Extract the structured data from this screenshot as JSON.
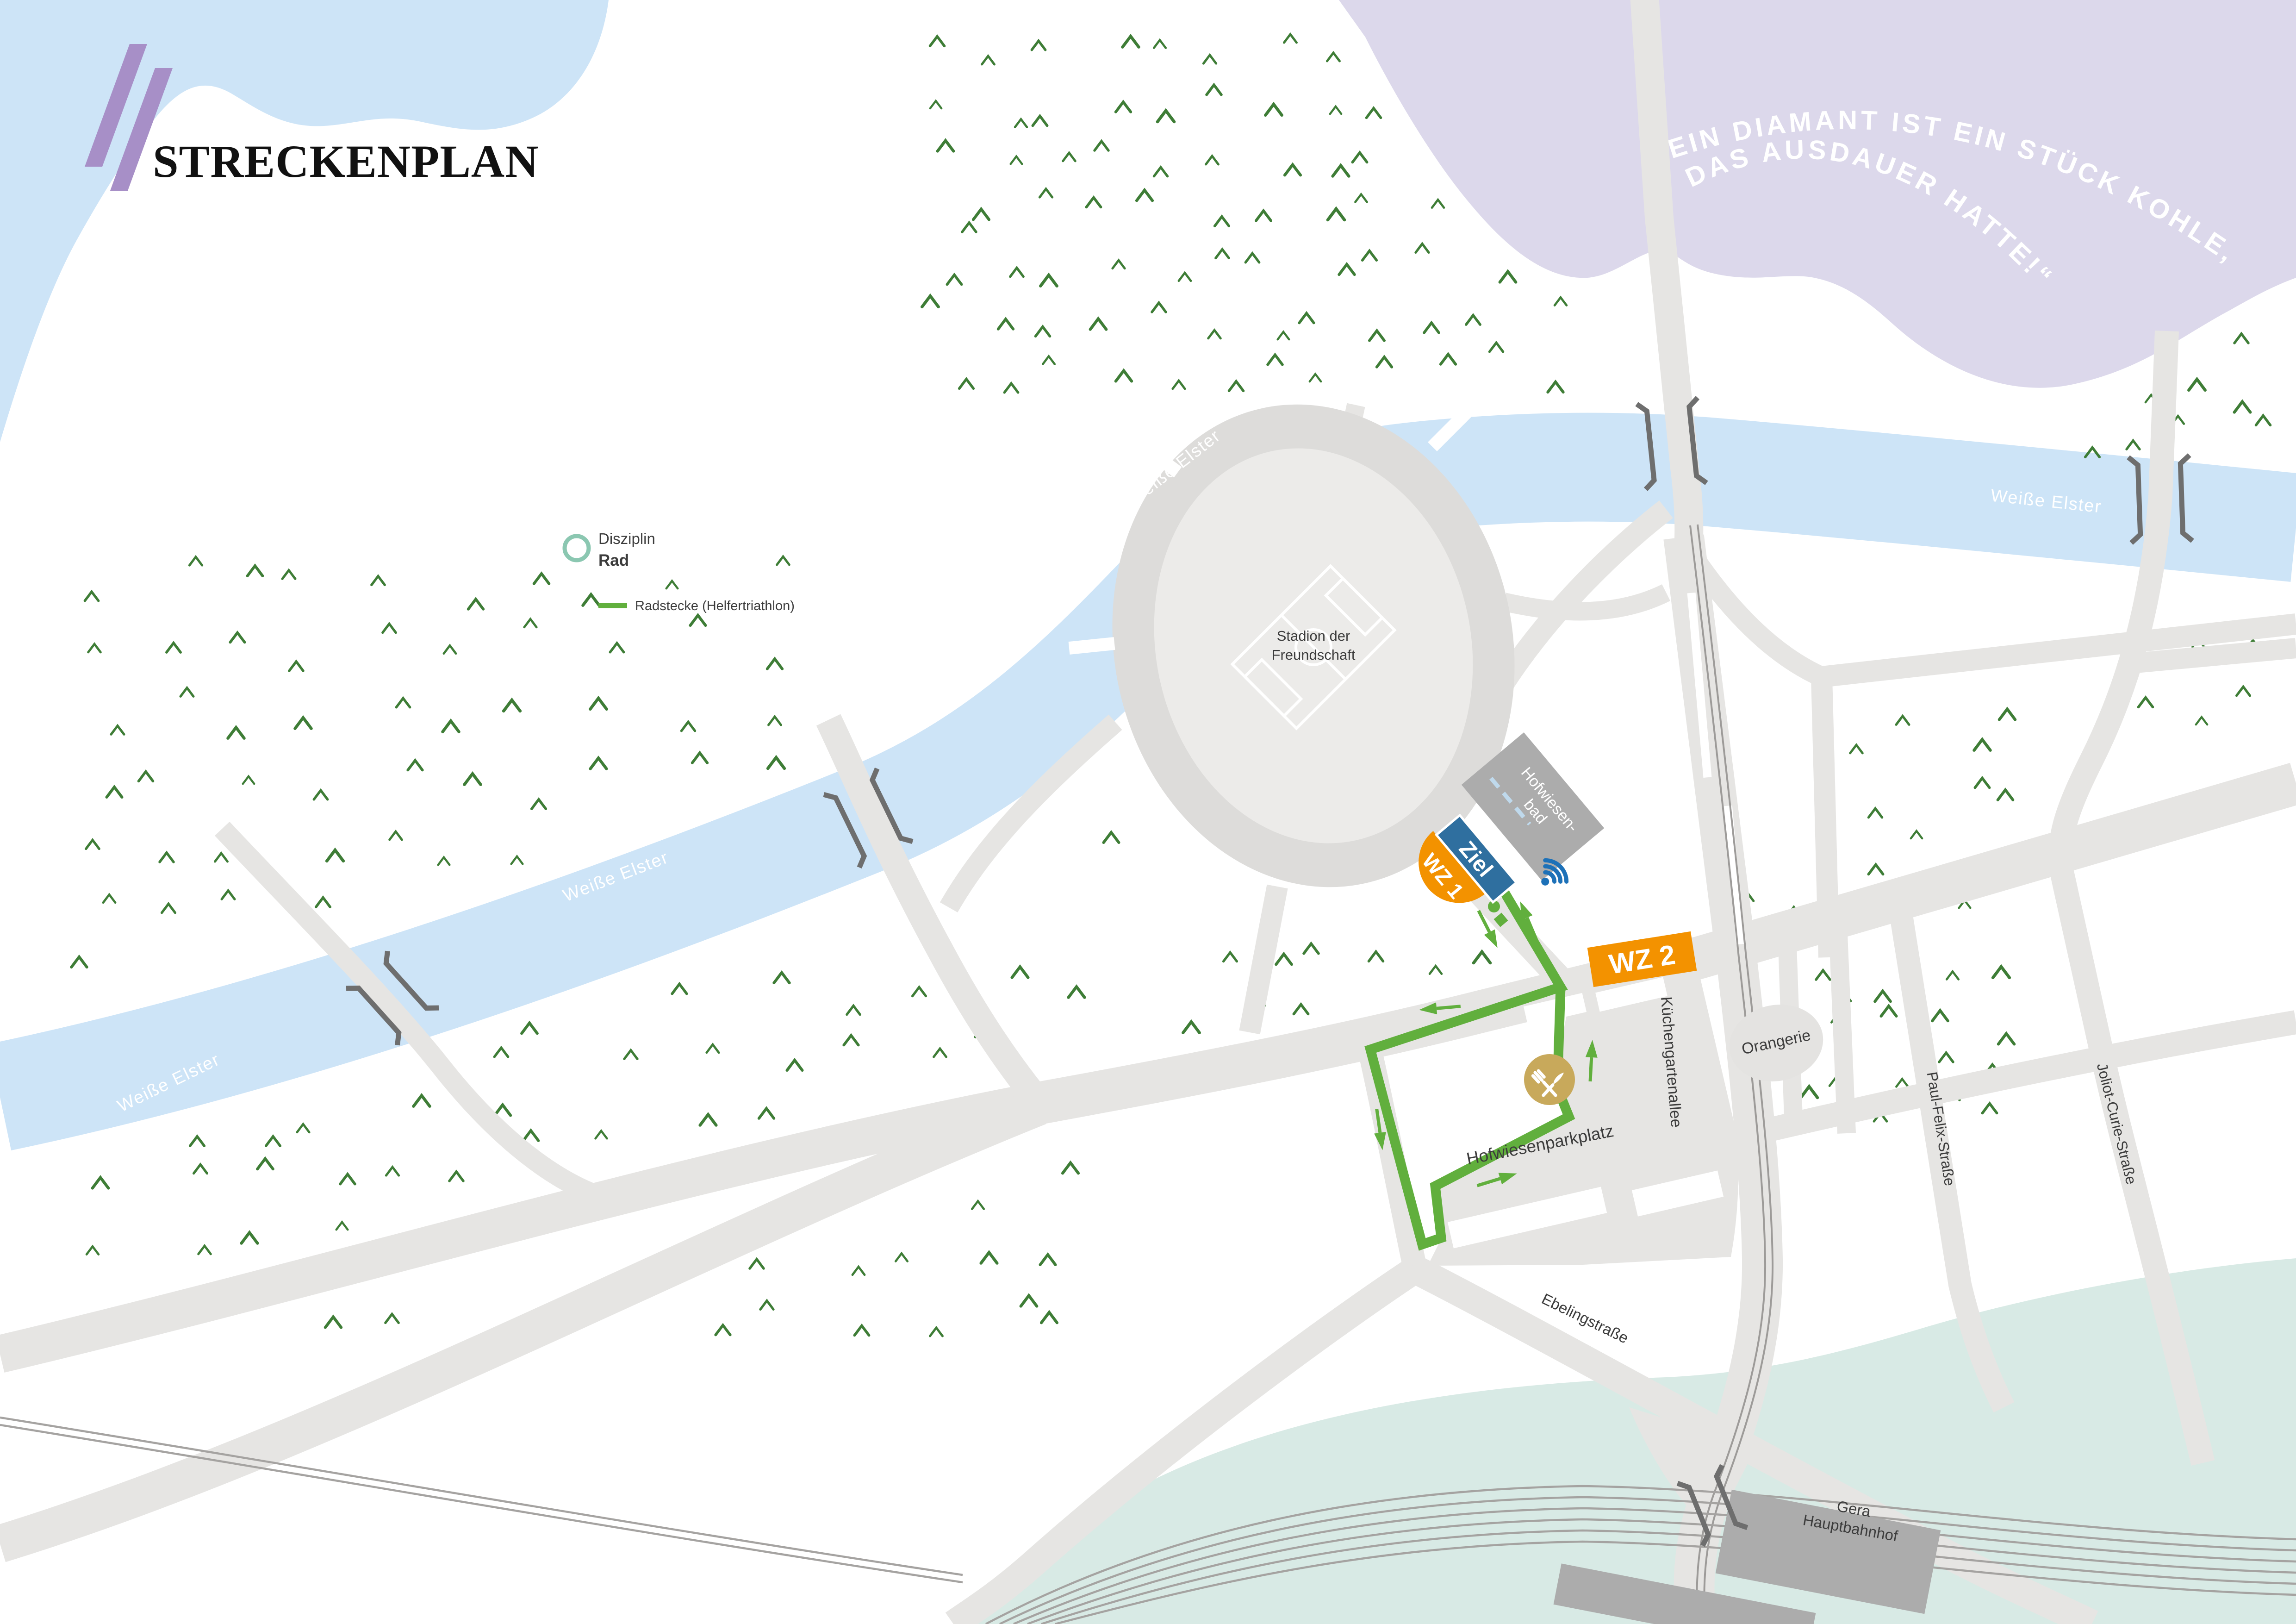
{
  "logo": {
    "text": "STRECKENPLAN"
  },
  "quote": {
    "line1": "„EIN DIAMANT IST EIN STÜCK KOHLE,",
    "line2": "DAS AUSDAUER HATTE!“"
  },
  "legend": {
    "discipline_label": "Disziplin",
    "discipline_value": "Rad",
    "route_label": "Radstecke (Helfertriathlon)"
  },
  "route_markers": {
    "finish": "Ziel",
    "transition1": "WZ 1",
    "transition2": "WZ 2"
  },
  "places": {
    "stadium_line1": "Stadion der",
    "stadium_line2": "Freundschaft",
    "pool_line1": "Hofwiesen-",
    "pool_line2": "bad",
    "orangerie": "Orangerie",
    "parking": "Hofwiesenparkplatz",
    "station_line1": "Gera",
    "station_line2": "Hauptbahnhof"
  },
  "streets": {
    "kuechengartenallee": "Küchengartenallee",
    "paul_felix_strasse": "Paul-Felix-Straße",
    "joliot_curie_strasse": "Joliot-Curie-Straße",
    "ebelingstrasse": "Ebelingstraße"
  },
  "river": {
    "name": "Weiße Elster"
  },
  "icons": {
    "food": "fork-knife-icon",
    "announcement": "sound-icon",
    "discipline": "ring-icon"
  },
  "colors": {
    "water": "#cde4f7",
    "purple": "#dcd8eb",
    "logoPurple": "#a78fc7",
    "mint": "#d8eae5",
    "road": "#e6e5e3",
    "ringGray": "#dddcda",
    "fieldGray": "#ecebe9",
    "building": "#acacac",
    "tree": "#3e7d36",
    "route": "#61af3d",
    "orange": "#f39200",
    "zielBlue": "#2f6f9f",
    "wifiBlue": "#1d71b8",
    "food": "#c8a95b",
    "legendTeal": "#8bc7b1",
    "label": "#3c3c3c"
  }
}
